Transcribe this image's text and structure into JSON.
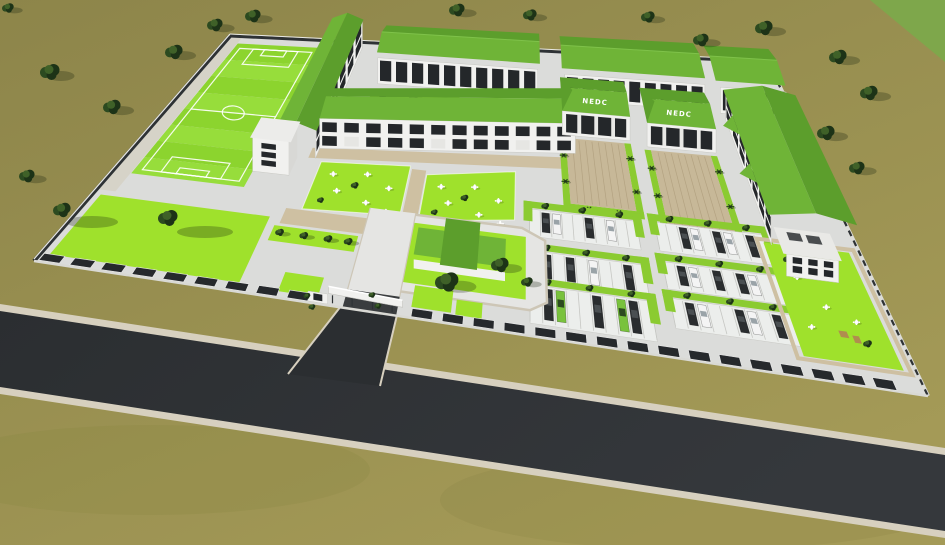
{
  "scene": {
    "type": "aerial-3d-architectural-site-render",
    "signs": [
      {
        "text": "NEDC"
      },
      {
        "text": "NEDC"
      }
    ],
    "features": [
      "football-field",
      "west-classroom-block",
      "central-classroom-block",
      "north-arcade-blocks",
      "nedc-halls",
      "east-residential-block",
      "parking-clusters",
      "courtyard-gardens",
      "sculpture-garden",
      "entrance-gatehouse",
      "perimeter-wall",
      "access-road",
      "lawns",
      "trees"
    ]
  },
  "colors": {
    "ground_far": "#8d854a",
    "ground_near": "#a49a57",
    "distant_field": "#7ea74b",
    "road": "#2b2e31",
    "road_light": "#35383c",
    "curb": "#d7d0bf",
    "pavement": "#dbdcda",
    "pavement_light": "#e5e5e3",
    "walkway_tan": "#cec0a2",
    "forecourt_tan": "#c7b898",
    "forecourt_line": "#b3a281",
    "field_green": "#8cd42e",
    "field_stripe": "#97dd3b",
    "lawn_green": "#9fe12c",
    "hedge_green": "#8bcb31",
    "roof_green": "#6fb437",
    "roof_green_dark": "#5c9e2c",
    "roof_green_light": "#7fc24a",
    "building_white": "#f1f1ef",
    "building_shade": "#d8d8d5",
    "window_dark": "#24272a",
    "wall_dark": "#2e3235",
    "wall_light": "#e8e8e5",
    "tree_dark": "#1d3317",
    "tree_mid": "#2c4a20",
    "tree_light": "#3f6128",
    "car_white": "#f4f4f4",
    "car_dark": "#2a2d2f",
    "car_green": "#79c23d",
    "marking_white": "#ffffff",
    "shadow": "rgba(25,35,15,0.28)",
    "sign_text": "#ffffff"
  }
}
